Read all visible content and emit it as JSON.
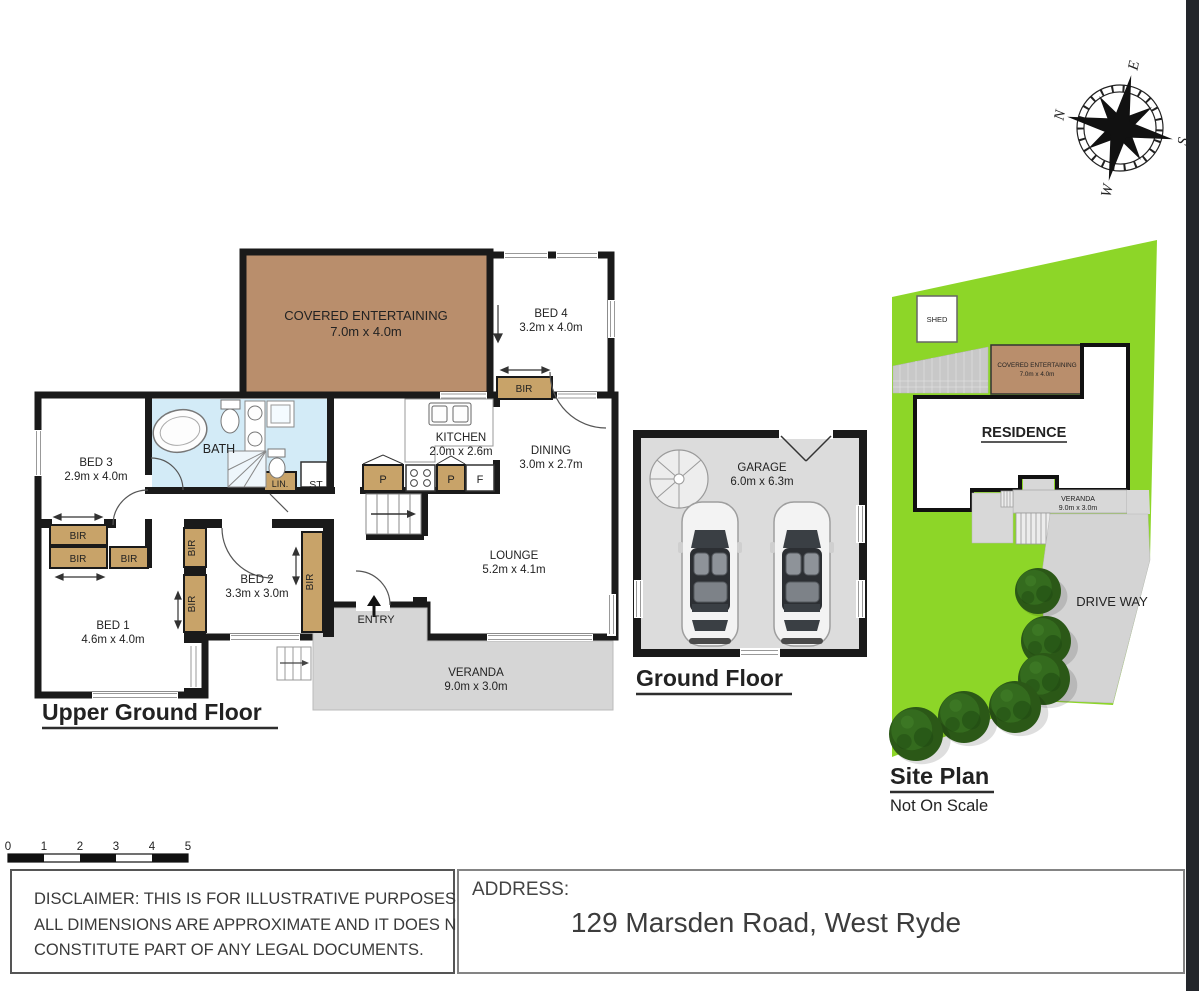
{
  "labels": {
    "bir": "BIR",
    "p": "P",
    "f": "F",
    "lin": "LIN.",
    "st": "ST",
    "entry": "ENTRY",
    "bath": "BATH"
  },
  "upper": {
    "title": "Upper Ground Floor",
    "covered": {
      "name": "COVERED ENTERTAINING",
      "dims": "7.0m x 4.0m"
    },
    "bed4": {
      "name": "BED 4",
      "dims": "3.2m x 4.0m"
    },
    "kitchen": {
      "name": "KITCHEN",
      "dims": "2.0m x 2.6m"
    },
    "dining": {
      "name": "DINING",
      "dims": "3.0m x 2.7m"
    },
    "bed3": {
      "name": "BED 3",
      "dims": "2.9m x 4.0m"
    },
    "bed2": {
      "name": "BED 2",
      "dims": "3.3m x 3.0m"
    },
    "bed1": {
      "name": "BED 1",
      "dims": "4.6m x 4.0m"
    },
    "lounge": {
      "name": "LOUNGE",
      "dims": "5.2m x 4.1m"
    },
    "veranda": {
      "name": "VERANDA",
      "dims": "9.0m x 3.0m"
    }
  },
  "ground": {
    "title": "Ground Floor",
    "garage": {
      "name": "GARAGE",
      "dims": "6.0m x 6.3m"
    }
  },
  "site": {
    "title": "Site Plan",
    "subtitle": "Not On Scale",
    "shed": "SHED",
    "residence": "RESIDENCE",
    "covered": {
      "name": "COVERED ENTERTAINING",
      "dims": "7.0m x 4.0m"
    },
    "veranda": {
      "name": "VERANDA",
      "dims": "9.0m x 3.0m"
    },
    "driveway": "DRIVE WAY"
  },
  "compass": {
    "n": "N",
    "e": "E",
    "s": "S",
    "w": "W"
  },
  "scalebar": {
    "ticks": [
      "0",
      "1",
      "2",
      "3",
      "4",
      "5"
    ]
  },
  "footer": {
    "disclaimer_lines": [
      "DISCLAIMER: THIS IS FOR ILLUSTRATIVE PURPOSES ONLY.",
      "ALL DIMENSIONS ARE APPROXIMATE AND IT DOES NOT",
      "CONSTITUTE PART OF ANY LEGAL DOCUMENTS."
    ],
    "address_label": "ADDRESS:",
    "address": "129 Marsden Road, West Ryde"
  },
  "colors": {
    "wall": "#1a1a1a",
    "covered": "#b98e6c",
    "covered_text": "#5e3d28",
    "bath": "#d3ebf7",
    "robe": "#c8a369",
    "veranda": "#d6d6d6",
    "garage": "#dcdcdc",
    "grass": "#8dd628",
    "driveway": "#d4d4d4",
    "tree": "#2b5817"
  }
}
